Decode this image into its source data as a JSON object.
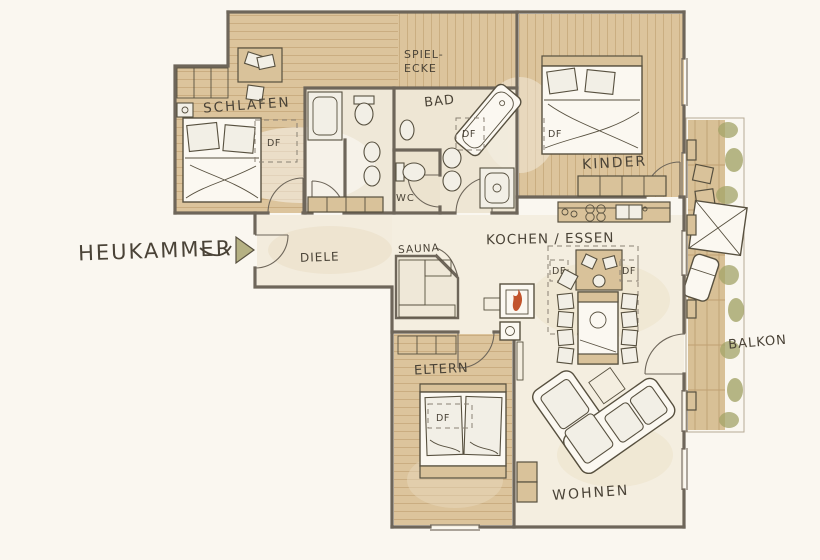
{
  "document": {
    "type": "apartment floor plan",
    "style": "hand-drawn watercolor sketch"
  },
  "rooms": [
    {
      "id": "schlafen",
      "label": "SCHLAFEN"
    },
    {
      "id": "spielecke",
      "label": "SPIEL-ECKE",
      "label_line1": "SPIEL-",
      "label_line2": "ECKE"
    },
    {
      "id": "bad",
      "label": "BAD"
    },
    {
      "id": "wc",
      "label": "WC"
    },
    {
      "id": "kinder",
      "label": "KINDER"
    },
    {
      "id": "diele",
      "label": "DIELE"
    },
    {
      "id": "sauna",
      "label": "SAUNA"
    },
    {
      "id": "kochen-essen",
      "label": "KOCHEN / ESSEN"
    },
    {
      "id": "eltern",
      "label": "ELTERN"
    },
    {
      "id": "wohnen",
      "label": "WOHNEN"
    },
    {
      "id": "balkon",
      "label": "BALKON"
    },
    {
      "id": "heukammer",
      "label": "HEUKAMMER"
    }
  ],
  "annotations": {
    "roof_window": "DF"
  },
  "colors": {
    "paper": "#faf7f0",
    "wood": "#dcc49c",
    "wood_line": "#c6a87a",
    "deck": "#d8c096",
    "wall": "#6e665a",
    "ink": "#4a4337",
    "room_tint": "#f1e9d9",
    "cabinet": "#d9c29a",
    "plant": "#a3a468",
    "flame": "#c2542c",
    "arrow": "#b5b183"
  }
}
